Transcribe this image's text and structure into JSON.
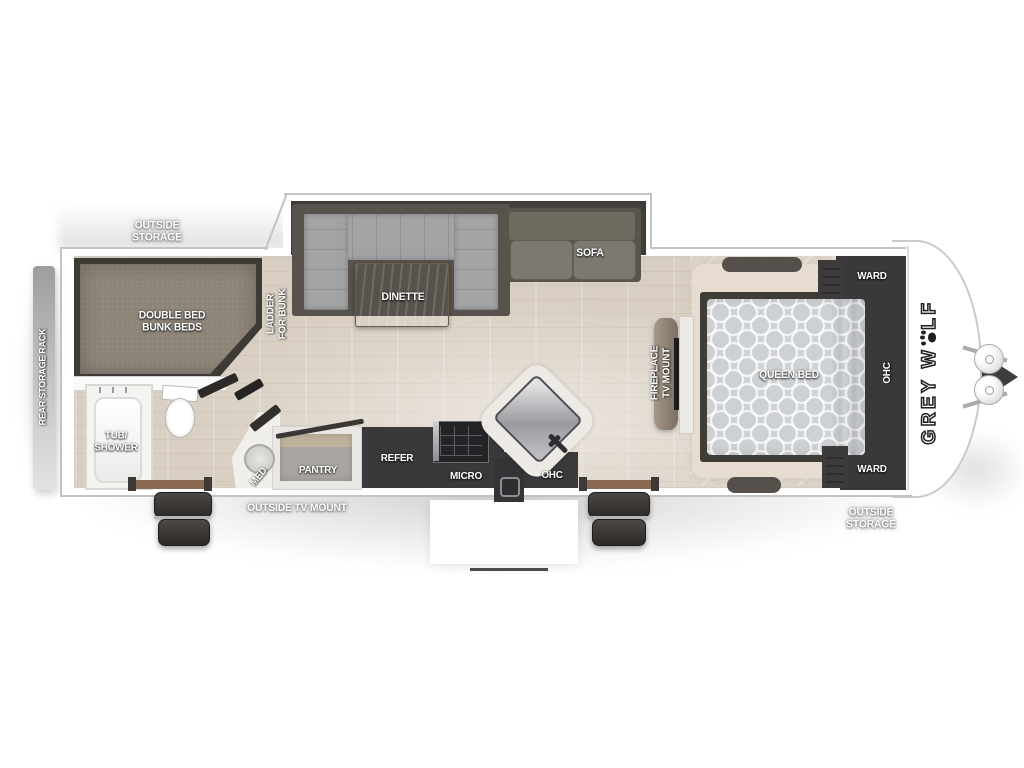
{
  "plan": {
    "description": "Travel trailer floor plan, top-down view",
    "brand": {
      "prefix": "GREY W",
      "suffix": "LF",
      "icon": "paw-print-icon"
    },
    "labels": {
      "outside_storage_rear": "OUTSIDE\nSTORAGE",
      "rear_storage_rack": "REAR STORAGE RACK",
      "double_bed_bunk_beds": "DOUBLE BED\nBUNK BEDS",
      "ladder_for_bunk": "LADDER\nFOR BUNK",
      "dinette": "DINETTE",
      "sofa": "SOFA",
      "tub_shower": "TUB/\nSHOWER",
      "med": "MED",
      "pantry": "PANTRY",
      "refer": "REFER",
      "micro": "MICRO",
      "ohc_kitchen": "OHC",
      "outside_tv_mount": "OUTSIDE TV MOUNT",
      "fireplace_tv_mount": "FIREPLACE\nTV MOUNT",
      "queen_bed": "QUEEN BED",
      "ward_top": "WARD",
      "ohc_bedroom": "OHC",
      "ward_bottom": "WARD",
      "outside_storage_front": "OUTSIDE\nSTORAGE"
    },
    "colors": {
      "body_white": "#ffffff",
      "wall_line": "#c3c3c3",
      "floor_wood": "#d8cec1",
      "bedroom_floor": "#ddd3c6",
      "slideout_platform": "#4a4440",
      "cabinet_dark": "#3a393b",
      "bunk_mattress": "#8e8579",
      "cushion_gray": "#a2a3a5",
      "sofa_gray": "#6e6a60",
      "table_wood": "#a89a82",
      "queen_mattress": "#ced1d4",
      "threshold_brown": "#8a6a52",
      "label_white": "#ffffff"
    }
  }
}
